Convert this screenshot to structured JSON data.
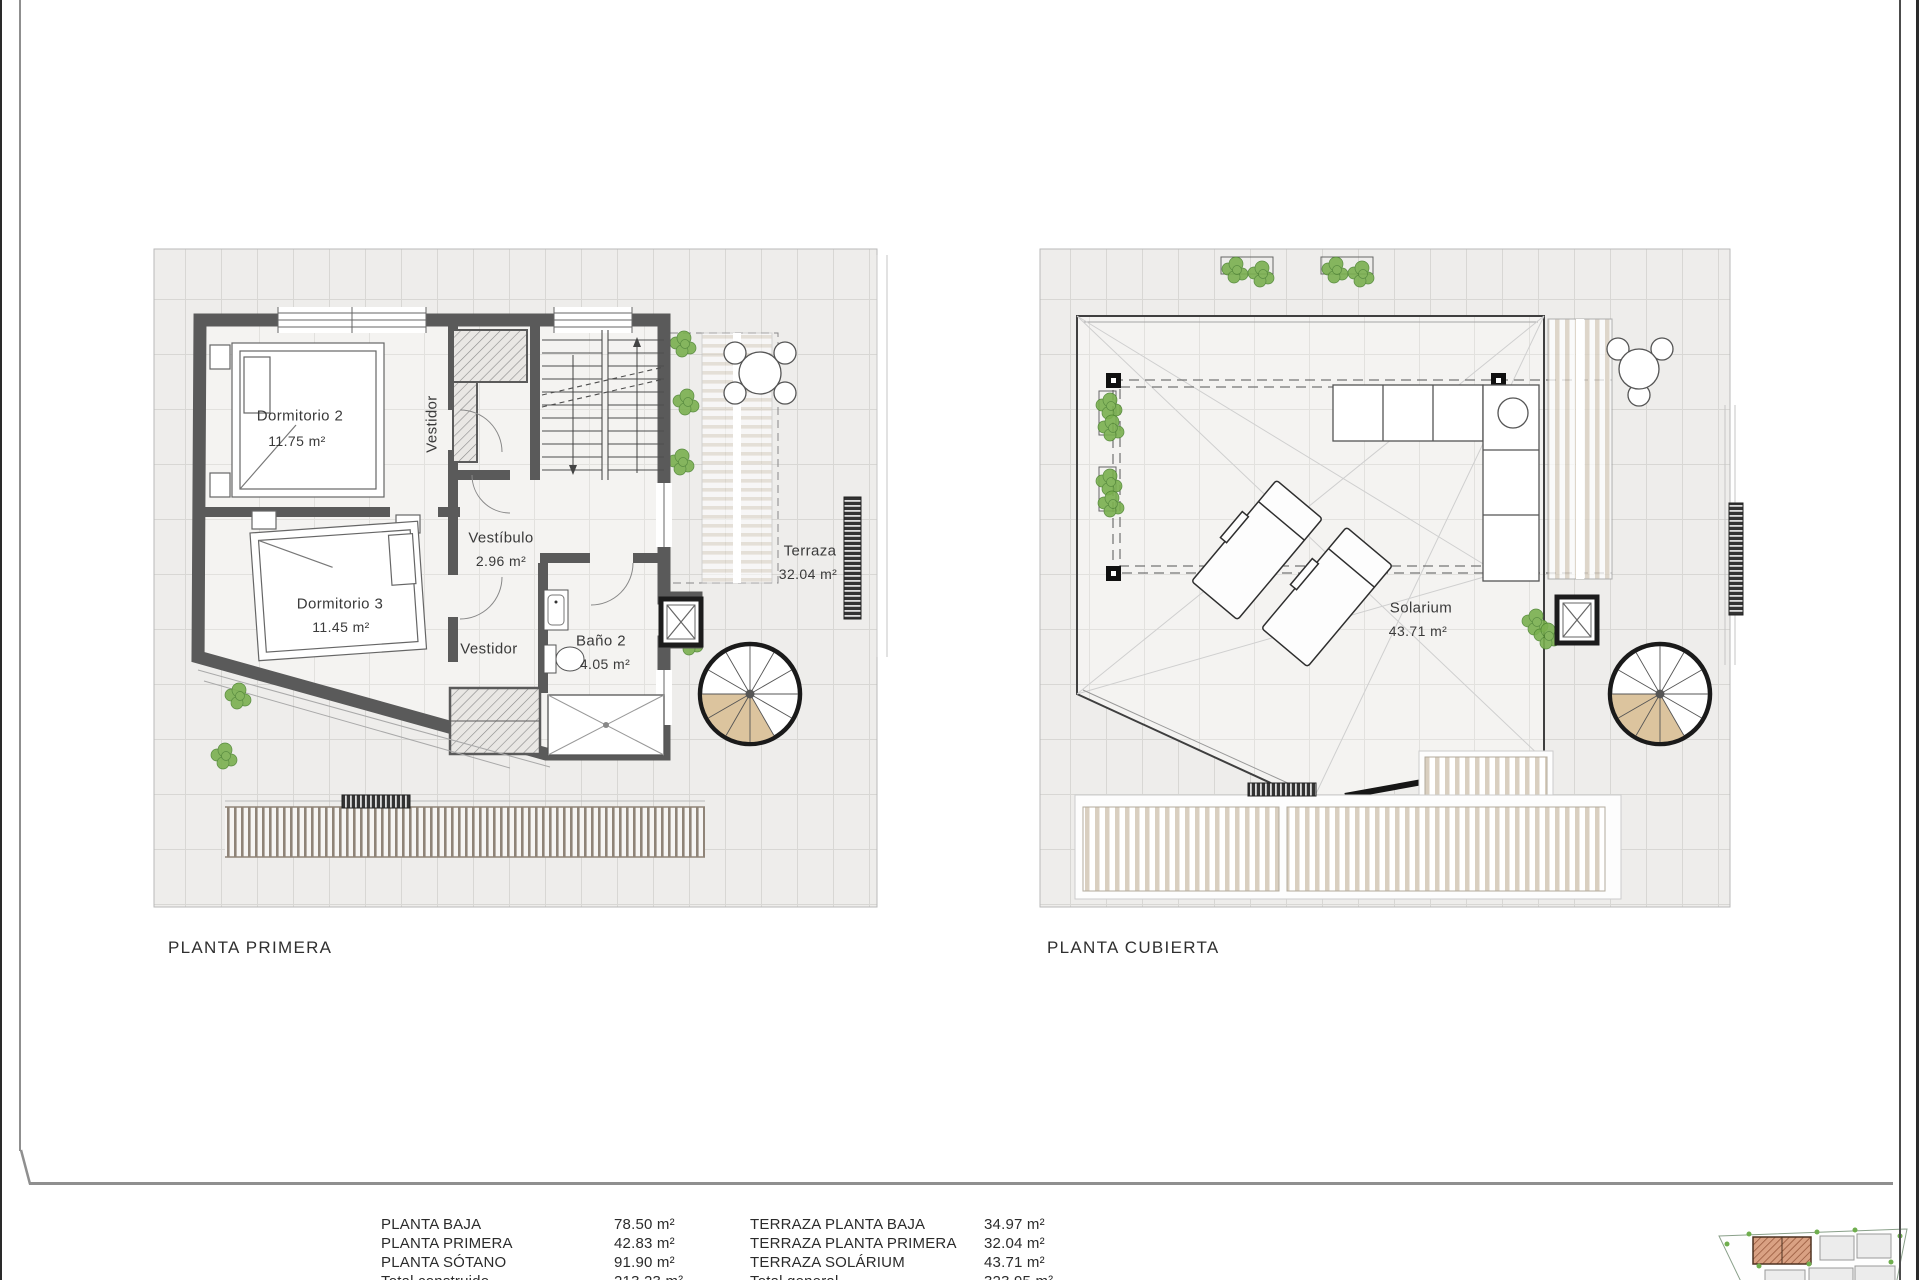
{
  "plans": {
    "left": {
      "title": "PLANTA PRIMERA",
      "rooms": {
        "dormitorio2": {
          "name": "Dormitorio 2",
          "area": "11.75 m²"
        },
        "dormitorio3": {
          "name": "Dormitorio 3",
          "area": "11.45 m²"
        },
        "vestidor_top": {
          "name": "Vestidor"
        },
        "vestibulo": {
          "name": "Vestíbulo",
          "area": "2.96 m²"
        },
        "vestidor_bottom": {
          "name": "Vestidor"
        },
        "bano2": {
          "name": "Baño 2",
          "area": "4.05 m²"
        },
        "terraza": {
          "name": "Terraza",
          "area": "32.04 m²"
        }
      }
    },
    "right": {
      "title": "PLANTA CUBIERTA",
      "rooms": {
        "solarium": {
          "name": "Solarium",
          "area": "43.71 m²"
        }
      }
    }
  },
  "areas_table": {
    "floors": [
      {
        "label": "PLANTA BAJA",
        "value": "78.50 m²"
      },
      {
        "label": "PLANTA PRIMERA",
        "value": "42.83 m²"
      },
      {
        "label": "PLANTA SÓTANO",
        "value": "91.90 m²"
      },
      {
        "label": "Total construido",
        "value": "213.23 m²"
      }
    ],
    "terraces": [
      {
        "label": "TERRAZA PLANTA BAJA",
        "value": "34.97 m²"
      },
      {
        "label": "TERRAZA PLANTA PRIMERA",
        "value": "32.04 m²"
      },
      {
        "label": "TERRAZA SOLÁRIUM",
        "value": "43.71 m²"
      },
      {
        "label": "Total general",
        "value": "323.95 m²"
      }
    ]
  },
  "colors": {
    "wall": "#5a5a5a",
    "tile_floor": "#eeedeb",
    "stair_wood": "#dcc49e",
    "slats": "#d9cfc0",
    "plants": "#7ab04f",
    "site_highlight": "#d9a183",
    "text": "#2b2b2b"
  }
}
